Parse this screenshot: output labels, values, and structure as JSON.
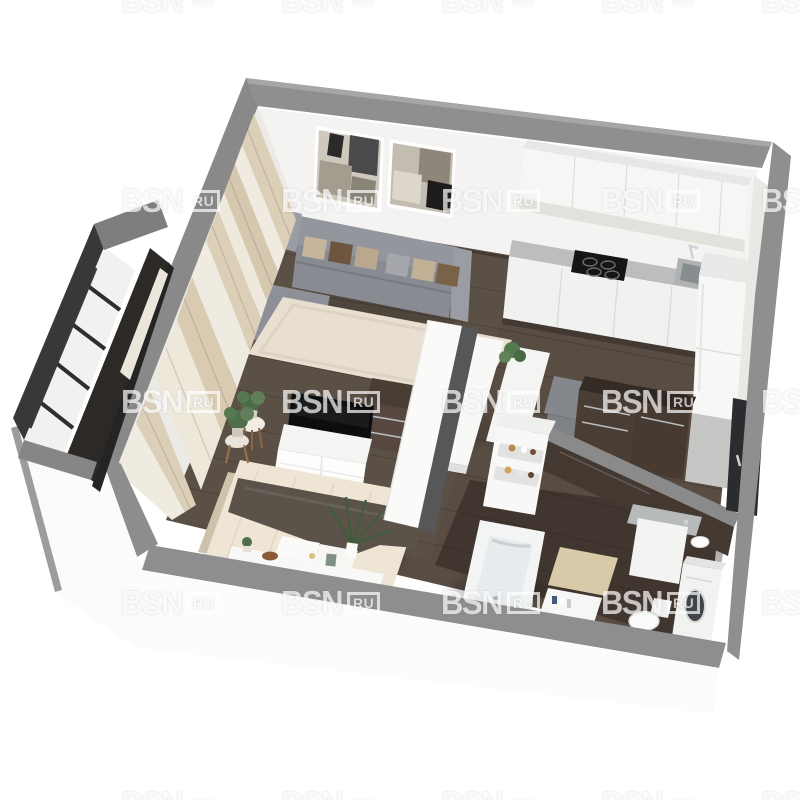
{
  "watermark": {
    "brand": "BSN",
    "suffix": "RU",
    "opacity": 0.82,
    "grid": {
      "columns_x": [
        121,
        281,
        441,
        601,
        761
      ],
      "rows_y": [
        -15,
        185,
        386,
        587,
        788
      ]
    }
  },
  "palette": {
    "background": "#ffffff",
    "wall_cap_gray": "#8d8d8d",
    "wall_interior_white": "#f4f3f1",
    "exterior_wall_white": "#fcfcfb",
    "floor_wood_dark": "#584c43",
    "floor_bathroom_dark": "#3e352c",
    "balcony_frame_dark": "#383838",
    "sofa_gray": "#8f919a",
    "rug_cream": "#e8dfd0",
    "kitchen_counter_gray": "#bdbdbb",
    "cabinet_white": "#f6f6f5",
    "hob_black": "#151515",
    "dark_wood_furniture": "#4a3e34",
    "bed_linen_cream": "#efe5d4",
    "throw_blanket_taupe": "#5b534a",
    "bath_mat_beige": "#d8caa8",
    "appliance_white": "#f2f2f1",
    "entry_door_dark": "#2b2c2f",
    "plant_green": "#567a50",
    "chrome": "#cfd2d4",
    "curtain_beige": "#dbcfb8",
    "curtain_sheer": "#f0ebe1"
  },
  "scene": {
    "kind": "3d-cutaway-floorplan-render",
    "rooms": [
      {
        "id": "living-room",
        "items": [
          "corner-sofa",
          "pillows",
          "wall-art-frames",
          "area-rug",
          "curtains",
          "side-table-plant"
        ]
      },
      {
        "id": "kitchen",
        "items": [
          "upper-cabinets",
          "backsplash",
          "countertop",
          "induction-hob",
          "sink-faucet",
          "lower-cabinets",
          "fridge",
          "dining-table",
          "dining-bench",
          "chairs",
          "table-plant"
        ]
      },
      {
        "id": "bedroom",
        "items": [
          "double-bed",
          "throw-blanket",
          "pillows",
          "foot-console-decor",
          "tv",
          "tv-stand",
          "dresser",
          "stool-plant",
          "bedroom-rug"
        ]
      },
      {
        "id": "hallway",
        "items": [
          "wardrobes",
          "entry-door"
        ]
      },
      {
        "id": "bathroom",
        "items": [
          "bathtub",
          "toiletry-shelf",
          "hand-basin",
          "vanity-washbasin",
          "toilet",
          "washing-machine",
          "bath-mat"
        ]
      },
      {
        "id": "balcony",
        "items": [
          "glazing",
          "window-frames",
          "balcony-floor",
          "parapet-wall"
        ]
      }
    ]
  }
}
